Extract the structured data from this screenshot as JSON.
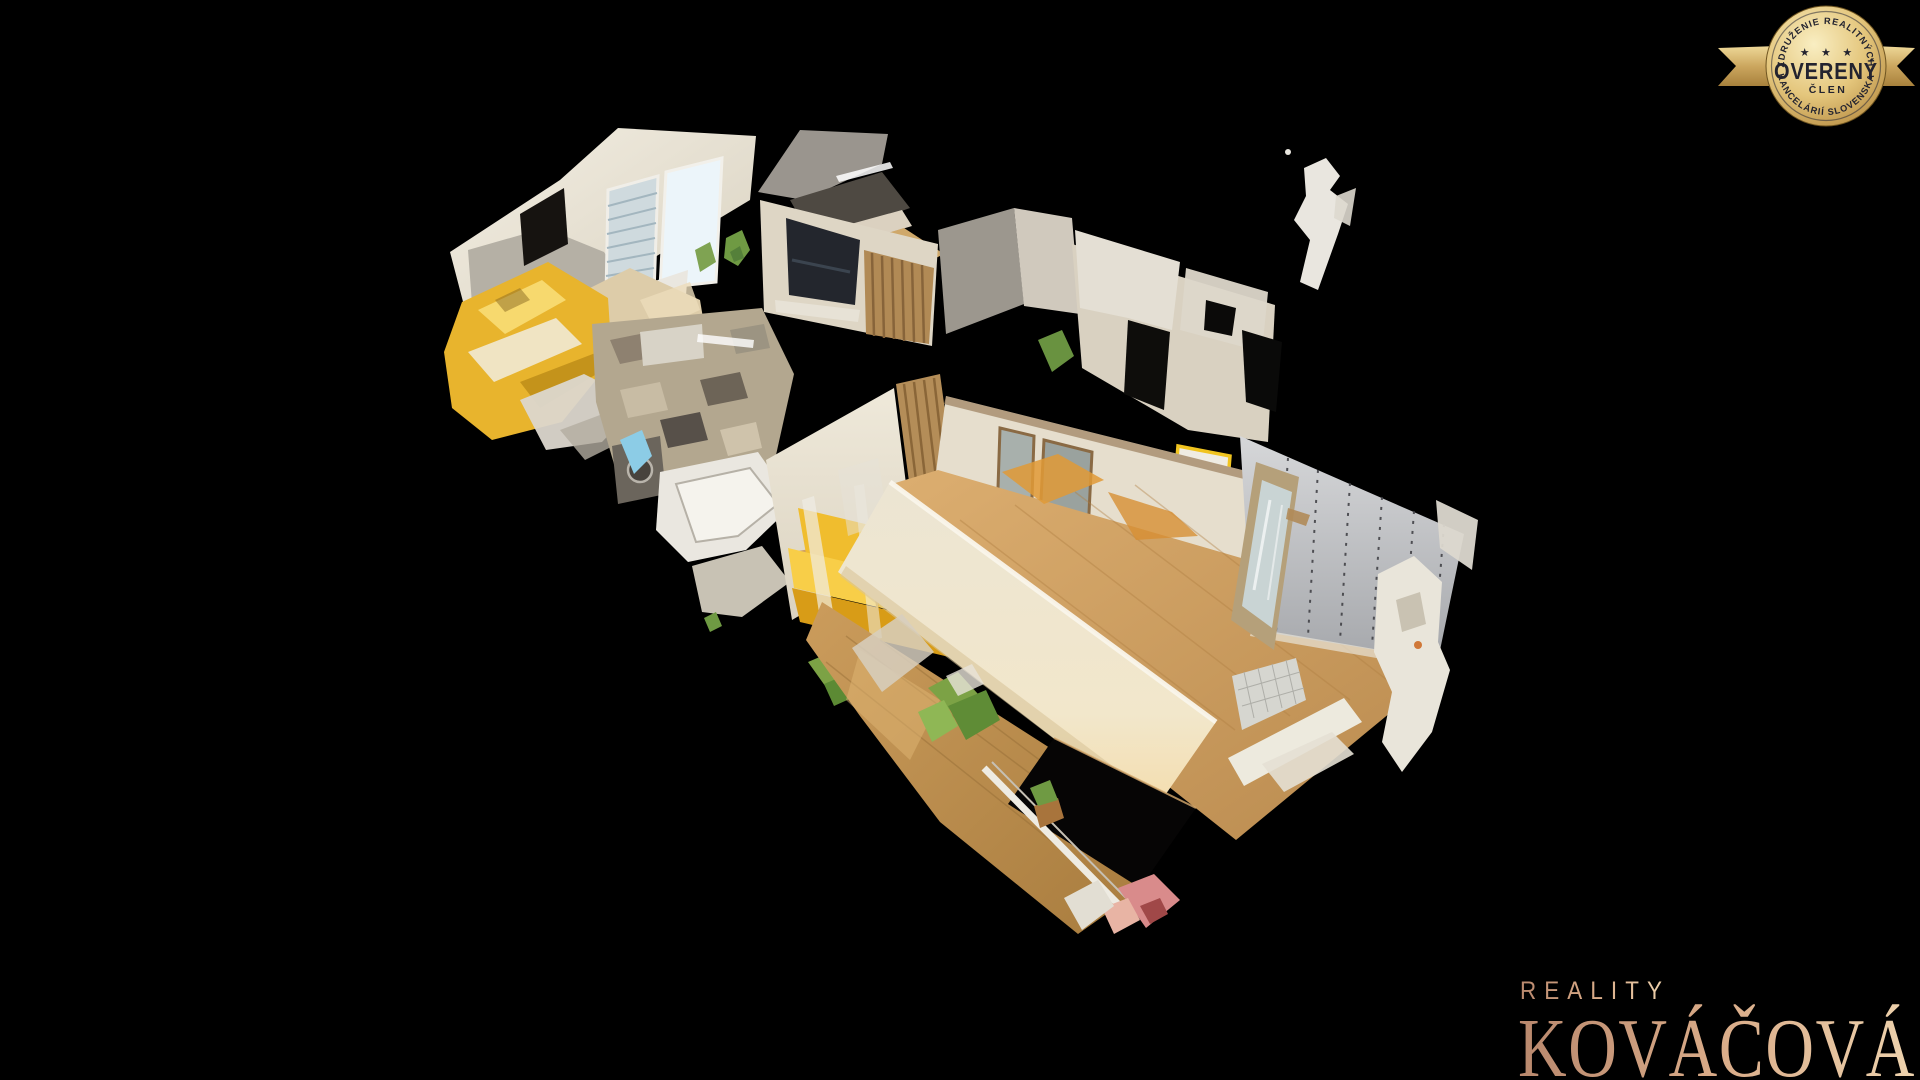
{
  "canvas": {
    "width": 1920,
    "height": 1080,
    "background": "#000000"
  },
  "badge": {
    "arc_top": "ZDRUŽENIE REALITNÝCH",
    "stars": "★ ★ ★",
    "title": "OVERENÝ",
    "subtitle": "ČLEN",
    "arc_bottom": "KANCELÁRIÍ SLOVENSKA",
    "colors": {
      "gold_light": "#f8ecc0",
      "gold": "#e3c379",
      "gold_deep": "#b98f44",
      "ribbon": "#caa55e",
      "text_navy": "#23232f"
    }
  },
  "logo": {
    "line1": "REALITY",
    "line2": "KOVÁČOVÁ",
    "gradient_from": "#b9886d",
    "gradient_mid": "#d9ab88",
    "gradient_to": "#eed3ae"
  },
  "scene": {
    "description": "3D dollhouse scan of an apartment interior viewed from above on a black background",
    "palette": {
      "wall_cream": "#ece5d6",
      "wall_grey_panel": "#c2c3c6",
      "floor_wood": "#c89a5e",
      "sofa_yellow": "#f2c238",
      "bed_yellow": "#e8b42d",
      "window_sky": "#ecf5fa",
      "blinds": "#cfdade",
      "tv_dark": "#23262d",
      "wood_slats": "#b18a55",
      "plant_green": "#7ca245",
      "door_accent_yellow": "#f1c41f",
      "hole_dark": "#060505"
    }
  }
}
